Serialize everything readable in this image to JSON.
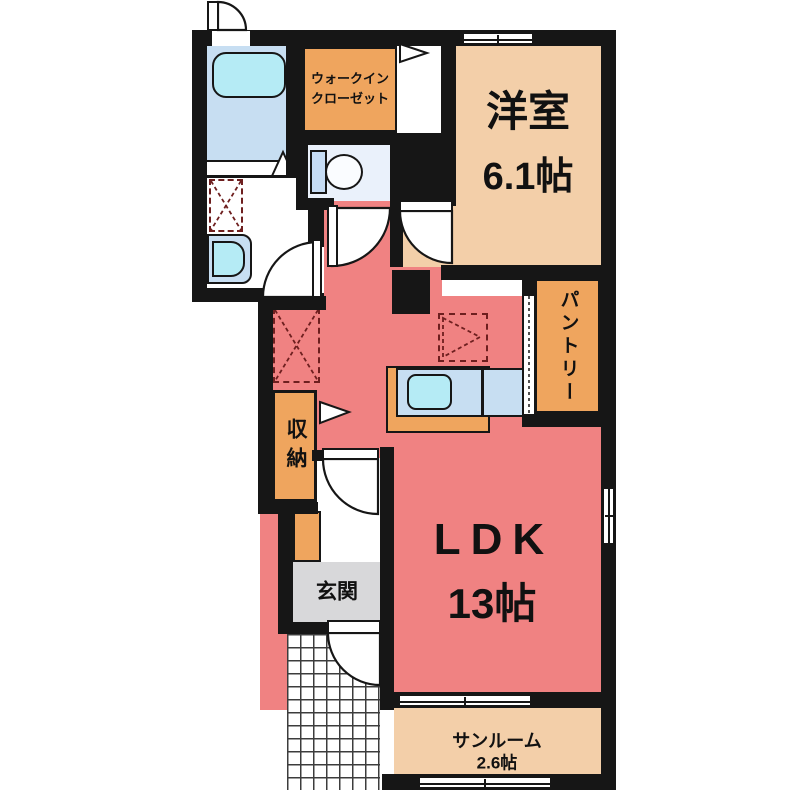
{
  "plan_title": "1LDK apartment floor plan",
  "rooms": {
    "western": {
      "name": "洋室",
      "size": "6.1帖"
    },
    "ldk": {
      "name": "LDK",
      "size": "13帖"
    },
    "sunroom": {
      "name": "サンルーム",
      "size": "2.6帖"
    },
    "walkin_closet": {
      "name_line1": "ウォークイン",
      "name_line2": "クローゼット"
    },
    "pantry": {
      "name": "パントリー"
    },
    "storage": {
      "name": "収納"
    },
    "entrance": {
      "name": "玄関"
    }
  },
  "colors": {
    "wall": "#161616",
    "ldk_floor": "#F08282",
    "tatami_room_floor": "#F3CFA9",
    "closet_orange": "#EFA55E",
    "bathroom_blue": "#C7DEF2",
    "fixture_cyan": "#B5EBF5",
    "toilet_floor": "#EAF1FB",
    "entrance_grey": "#D8D8DA"
  }
}
